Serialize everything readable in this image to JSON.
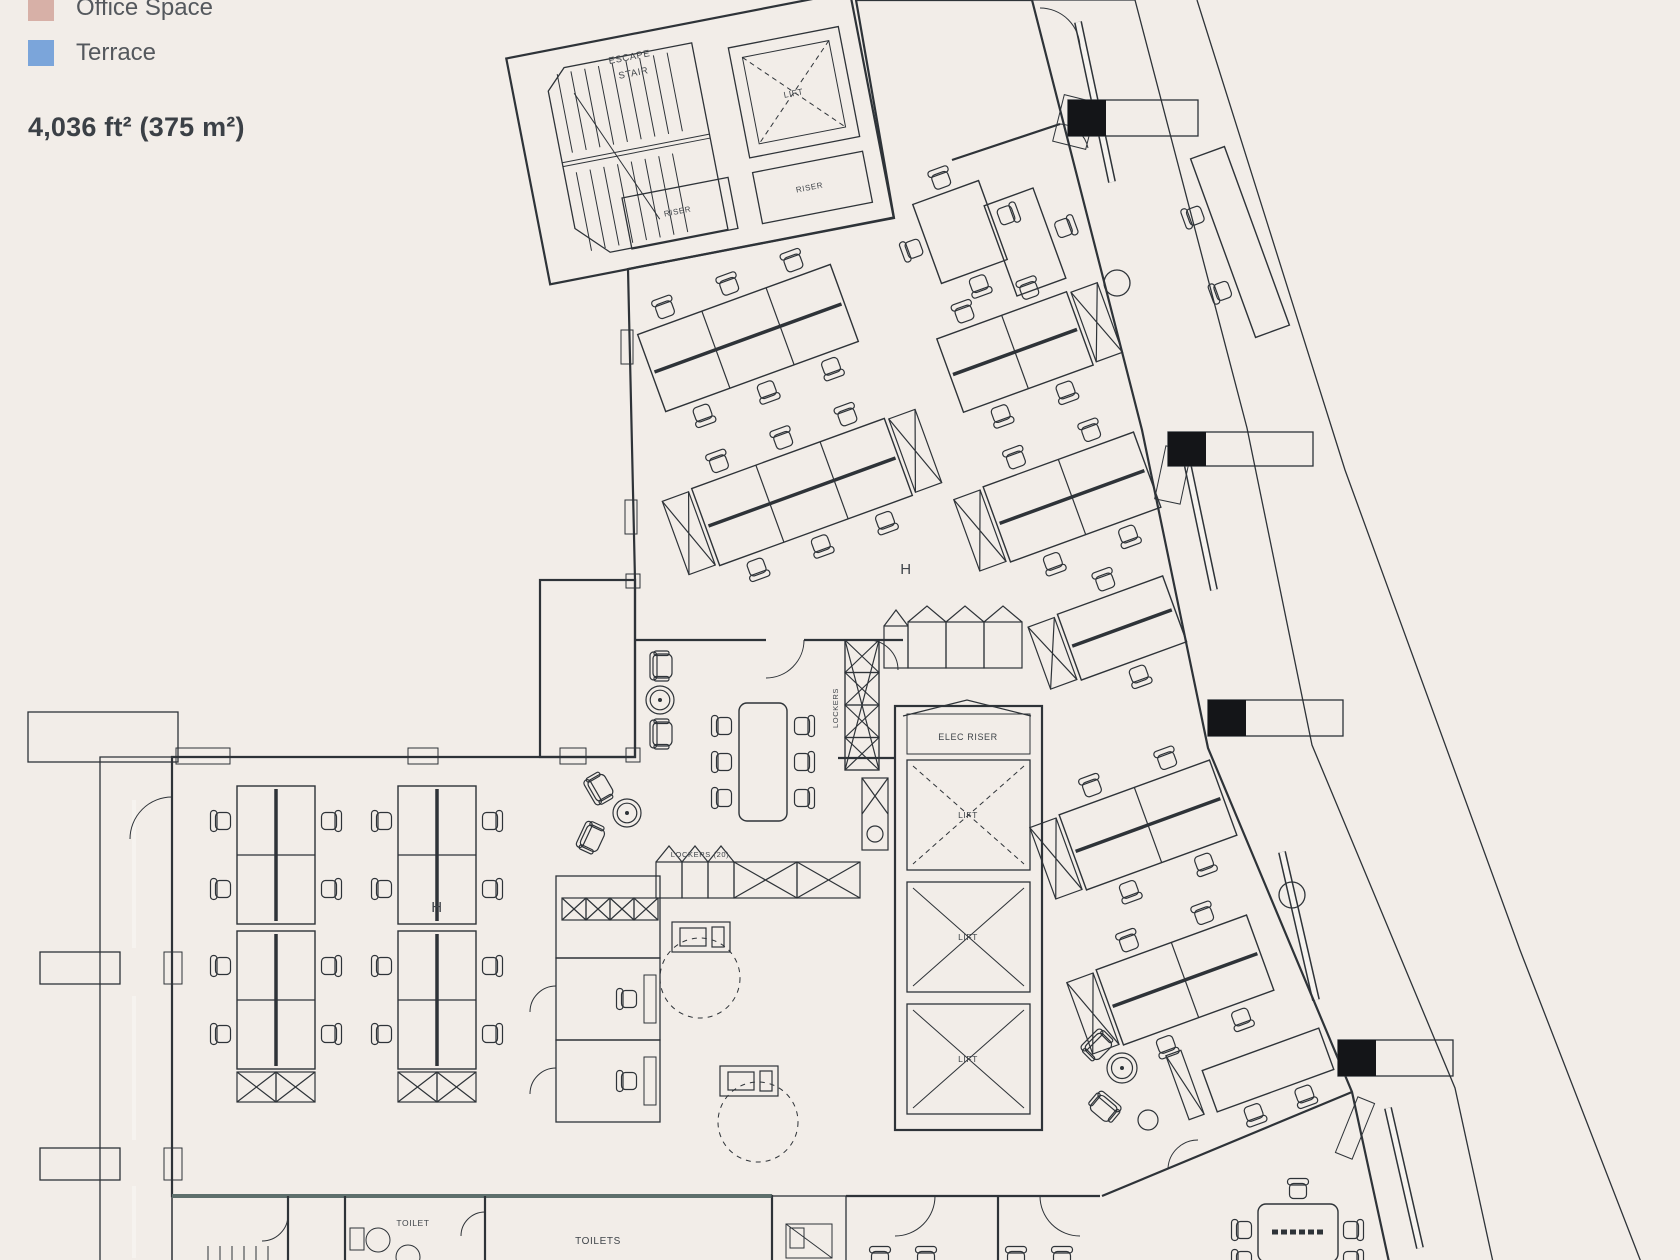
{
  "legend": {
    "items": [
      {
        "label": "Office Space",
        "color": "#d7b0a7"
      },
      {
        "label": "Terrace",
        "color": "#7ba5da"
      }
    ]
  },
  "area_label": "4,036 ft² (375 m²)",
  "plan": {
    "labels": {
      "escape1": "ESCAPE",
      "escape2": "STAIR",
      "riser": "RISER",
      "lift": "LIFT",
      "elec_riser": "ELEC RISER",
      "lockers": "LOCKERS",
      "lockers_20": "LOCKERS (20)",
      "toilet": "TOILET",
      "toilets": "TOILETS",
      "section_h": "H"
    },
    "colors": {
      "background": "#f2ede8",
      "office": "#dcb9b1",
      "terrace": "#7ba5da",
      "core": "#8d9697",
      "room": "#f6f3ee",
      "wall": "#2e3338",
      "label": "#3f4449",
      "black": "#141518",
      "white": "#f6f3ef"
    }
  }
}
